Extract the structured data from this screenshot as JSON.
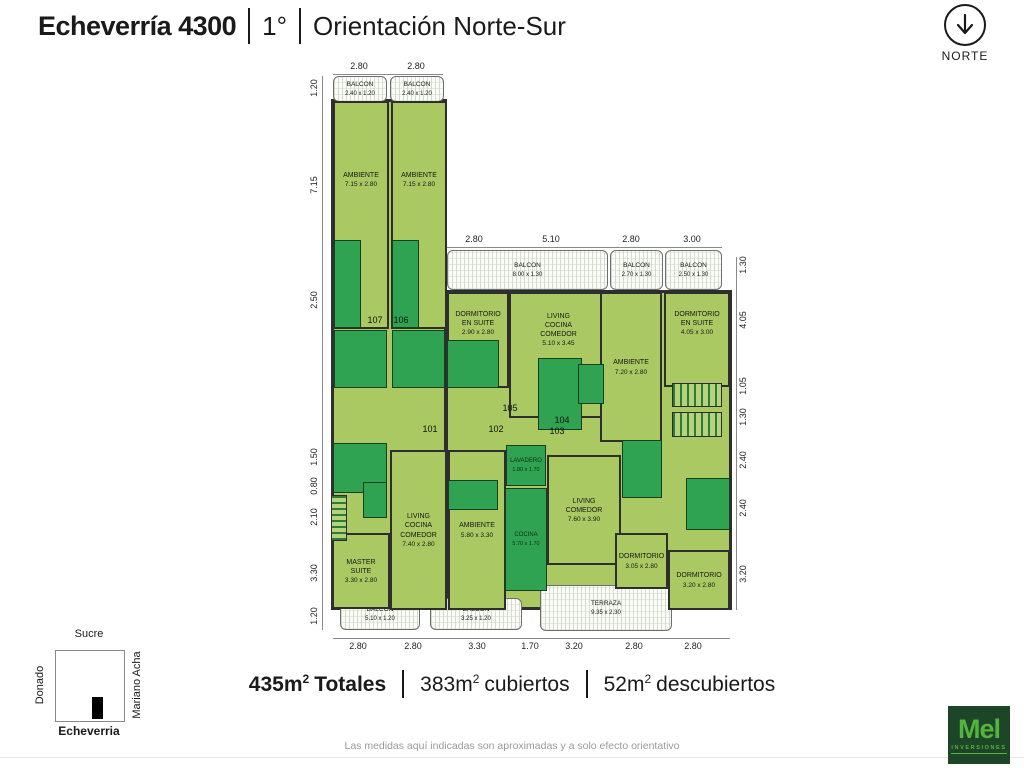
{
  "header": {
    "address": "Echeverría 4300",
    "floor": "1°",
    "orientation": "Orientación Norte-Sur"
  },
  "compass": {
    "label": "NORTE"
  },
  "plan": {
    "colors": {
      "room": "#aac963",
      "wet": "#2fa352",
      "wall": "#2e2e2e"
    },
    "base": [
      {
        "x": 31,
        "y": 41,
        "w": 116,
        "h": 511
      },
      {
        "x": 145,
        "y": 232,
        "w": 287,
        "h": 320
      }
    ],
    "balconies": [
      {
        "name": "BALCON",
        "dims": "2.40 x 1.20",
        "x": 33,
        "y": 18,
        "w": 54,
        "h": 26
      },
      {
        "name": "BALCON",
        "dims": "2.40 x 1.20",
        "x": 90,
        "y": 18,
        "w": 54,
        "h": 26
      },
      {
        "name": "BALCON",
        "dims": "8.00 x 1.30",
        "x": 147,
        "y": 192,
        "w": 161,
        "h": 40
      },
      {
        "name": "BALCON",
        "dims": "2.70 x 1.30",
        "x": 310,
        "y": 192,
        "w": 53,
        "h": 40
      },
      {
        "name": "BALCON",
        "dims": "2.50 x 1.30",
        "x": 365,
        "y": 192,
        "w": 57,
        "h": 40
      },
      {
        "name": "BALCON",
        "dims": "5.10 x 1.20",
        "x": 40,
        "y": 540,
        "w": 80,
        "h": 32
      },
      {
        "name": "BALCON",
        "dims": "3.25 x 1.20",
        "x": 130,
        "y": 540,
        "w": 92,
        "h": 32
      }
    ],
    "terrace": {
      "name": "TERRAZA",
      "dims": "9.35 x 2.30",
      "x": 240,
      "y": 527,
      "w": 132,
      "h": 46
    },
    "rooms": [
      {
        "name": "AMBIENTE",
        "dims": "7.15 x 2.80",
        "x": 33,
        "y": 43,
        "w": 56,
        "h": 228,
        "lp": 68
      },
      {
        "name": "AMBIENTE",
        "dims": "7.15 x 2.80",
        "x": 91,
        "y": 43,
        "w": 56,
        "h": 228,
        "lp": 68
      },
      {
        "name": "DORMITORIO\nEN SUITE",
        "dims": "2.90 x 2.80",
        "x": 147,
        "y": 234,
        "w": 62,
        "h": 96,
        "lp": 16
      },
      {
        "name": "LIVING\nCOCINA\nCOMEDOR",
        "dims": "5.10 x 3.45",
        "x": 209,
        "y": 234,
        "w": 99,
        "h": 126,
        "lp": 18
      },
      {
        "name": "AMBIENTE",
        "dims": "7.20 x 2.80",
        "x": 300,
        "y": 234,
        "w": 62,
        "h": 150
      },
      {
        "name": "DORMITORIO\nEN SUITE",
        "dims": "4.05 x 3.00",
        "x": 364,
        "y": 234,
        "w": 66,
        "h": 95,
        "lp": 16
      },
      {
        "name": "MASTER\nSUITE",
        "dims": "3.30 x 2.80",
        "x": 32,
        "y": 475,
        "w": 58,
        "h": 76
      },
      {
        "name": "LIVING\nCOCINA\nCOMEDOR",
        "dims": "7.40 x 2.80",
        "x": 90,
        "y": 392,
        "w": 57,
        "h": 160
      },
      {
        "name": "AMBIENTE",
        "dims": "5.80 x 3.30",
        "x": 148,
        "y": 392,
        "w": 58,
        "h": 160
      },
      {
        "name": "LIVING\nCOMEDOR",
        "dims": "7.60 x 3.90",
        "x": 247,
        "y": 397,
        "w": 74,
        "h": 110
      },
      {
        "name": "DORMITORIO",
        "dims": "3.05 x 2.80",
        "x": 315,
        "y": 475,
        "w": 53,
        "h": 56
      },
      {
        "name": "DORMITORIO",
        "dims": "3.20 x 2.80",
        "x": 368,
        "y": 492,
        "w": 62,
        "h": 60
      }
    ],
    "wet": [
      {
        "x": 34,
        "y": 182,
        "w": 27,
        "h": 88
      },
      {
        "x": 92,
        "y": 182,
        "w": 27,
        "h": 88
      },
      {
        "x": 34,
        "y": 272,
        "w": 53,
        "h": 58
      },
      {
        "x": 92,
        "y": 272,
        "w": 53,
        "h": 58
      },
      {
        "x": 147,
        "y": 282,
        "w": 52,
        "h": 48
      },
      {
        "x": 238,
        "y": 300,
        "w": 44,
        "h": 72
      },
      {
        "x": 278,
        "y": 306,
        "w": 26,
        "h": 40
      },
      {
        "x": 322,
        "y": 382,
        "w": 40,
        "h": 58
      },
      {
        "x": 386,
        "y": 420,
        "w": 44,
        "h": 52
      },
      {
        "x": 33,
        "y": 385,
        "w": 54,
        "h": 50
      },
      {
        "x": 148,
        "y": 422,
        "w": 50,
        "h": 30
      },
      {
        "x": 63,
        "y": 424,
        "w": 24,
        "h": 36
      },
      {
        "name": "COCINA",
        "dims": "5.70 x 1.70",
        "x": 205,
        "y": 430,
        "w": 42,
        "h": 103
      },
      {
        "name": "LAVADERO",
        "dims": "1.80 x 1.70",
        "x": 206,
        "y": 387,
        "w": 40,
        "h": 41
      }
    ],
    "stairs": [
      {
        "x": 31,
        "y": 437,
        "w": 16,
        "h": 46,
        "dir": "h"
      },
      {
        "x": 372,
        "y": 325,
        "w": 50,
        "h": 24,
        "dir": "v"
      },
      {
        "x": 372,
        "y": 354,
        "w": 50,
        "h": 25,
        "dir": "v"
      }
    ],
    "units": [
      {
        "t": "107",
        "x": 75,
        "y": 262
      },
      {
        "t": "106",
        "x": 101,
        "y": 262
      },
      {
        "t": "105",
        "x": 210,
        "y": 350
      },
      {
        "t": "104",
        "x": 262,
        "y": 362
      },
      {
        "t": "103",
        "x": 257,
        "y": 373
      },
      {
        "t": "101",
        "x": 130,
        "y": 371
      },
      {
        "t": "102",
        "x": 196,
        "y": 371
      }
    ],
    "dims": {
      "top": [
        {
          "v": "2.80",
          "x": 59,
          "y": 8
        },
        {
          "v": "2.80",
          "x": 116,
          "y": 8
        },
        {
          "v": "2.80",
          "x": 174,
          "y": 181
        },
        {
          "v": "5.10",
          "x": 251,
          "y": 181
        },
        {
          "v": "2.80",
          "x": 331,
          "y": 181
        },
        {
          "v": "3.00",
          "x": 392,
          "y": 181
        }
      ],
      "bottom": [
        {
          "v": "2.80",
          "x": 58,
          "y": 588
        },
        {
          "v": "2.80",
          "x": 113,
          "y": 588
        },
        {
          "v": "3.30",
          "x": 177,
          "y": 588
        },
        {
          "v": "1.70",
          "x": 230,
          "y": 588
        },
        {
          "v": "3.20",
          "x": 274,
          "y": 588
        },
        {
          "v": "2.80",
          "x": 334,
          "y": 588
        },
        {
          "v": "2.80",
          "x": 393,
          "y": 588
        }
      ],
      "left": [
        {
          "v": "1.20",
          "x": 14,
          "y": 30
        },
        {
          "v": "7.15",
          "x": 14,
          "y": 127
        },
        {
          "v": "2.50",
          "x": 14,
          "y": 242
        },
        {
          "v": "1.50",
          "x": 14,
          "y": 399
        },
        {
          "v": "0.80",
          "x": 14,
          "y": 428
        },
        {
          "v": "2.10",
          "x": 14,
          "y": 459
        },
        {
          "v": "3.30",
          "x": 14,
          "y": 515
        },
        {
          "v": "1.20",
          "x": 14,
          "y": 558
        }
      ],
      "right": [
        {
          "v": "1.30",
          "x": 443,
          "y": 207
        },
        {
          "v": "4.05",
          "x": 443,
          "y": 262
        },
        {
          "v": "1.05",
          "x": 443,
          "y": 328
        },
        {
          "v": "1.30",
          "x": 443,
          "y": 359
        },
        {
          "v": "2.40",
          "x": 443,
          "y": 402
        },
        {
          "v": "2.40",
          "x": 443,
          "y": 450
        },
        {
          "v": "3.20",
          "x": 443,
          "y": 516
        }
      ]
    }
  },
  "map": {
    "top": "Sucre",
    "left": "Donado",
    "right": "Mariano Acha",
    "bottom": "Echeverria"
  },
  "totals": {
    "items": [
      {
        "value": "435m",
        "sup": "2",
        "label": "Totales"
      },
      {
        "value": "383m",
        "sup": "2",
        "label": "cubiertos"
      },
      {
        "value": "52m",
        "sup": "2",
        "label": "descubiertos"
      }
    ]
  },
  "disclaimer": "Las medidas aquí indicadas son aproximadas y a solo efecto orientativo",
  "logo": {
    "name": "Mel",
    "sub": "INVERSIONES",
    "bg": "#1d4527",
    "fg": "#55b43d"
  }
}
